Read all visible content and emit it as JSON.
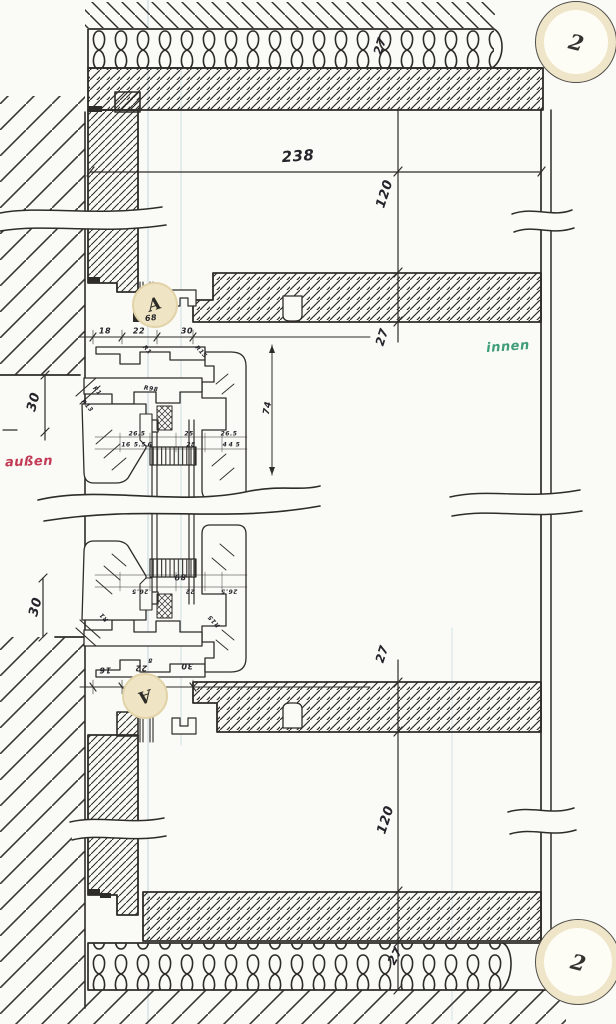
{
  "drawing": {
    "kind": "scanned hand-drawn window section detail",
    "outside_label": "außen",
    "inside_label": "innen"
  },
  "colors": {
    "paper": "#fafaf7",
    "ink": "#2e2c28",
    "red_label": "#c23a56",
    "green_label": "#3f9e78",
    "marker_beige": "#efe5c5",
    "scan_line": "#bcd3d8"
  },
  "markers": [
    {
      "letter": "A",
      "x": 155,
      "y": 305,
      "r": 21,
      "rot": -18,
      "style": "detail",
      "name": "detail-marker-a-top"
    },
    {
      "letter": "A",
      "x": 145,
      "y": 696,
      "r": 21,
      "rot": 162,
      "style": "detail",
      "name": "detail-marker-a-bottom"
    },
    {
      "letter": "2",
      "x": 576,
      "y": 42,
      "r": 40,
      "rot": 14,
      "style": "sheet",
      "name": "sheet-marker-2-top"
    },
    {
      "letter": "2",
      "x": 578,
      "y": 962,
      "r": 42,
      "rot": 14,
      "style": "sheet",
      "name": "sheet-marker-2-bottom"
    }
  ],
  "annotations": [
    {
      "text": "27",
      "x": 380,
      "y": 46,
      "rot": -72,
      "size": 12,
      "name": "dim-insulation-top"
    },
    {
      "text": "238",
      "x": 298,
      "y": 156,
      "rot": -4,
      "size": 15,
      "name": "dim-opening-width"
    },
    {
      "text": "120",
      "x": 385,
      "y": 194,
      "rot": -72,
      "size": 13,
      "name": "dim-reveal-top"
    },
    {
      "text": "27",
      "x": 382,
      "y": 337,
      "rot": -72,
      "size": 12,
      "name": "dim-lintel-top"
    },
    {
      "text": "30",
      "x": 34,
      "y": 402,
      "rot": -75,
      "size": 13,
      "name": "dim-left-top"
    },
    {
      "text": "30",
      "x": 36,
      "y": 607,
      "rot": -75,
      "size": 13,
      "name": "dim-left-bottom"
    },
    {
      "text": "27",
      "x": 382,
      "y": 654,
      "rot": -72,
      "size": 12,
      "name": "dim-lintel-bottom"
    },
    {
      "text": "120",
      "x": 386,
      "y": 820,
      "rot": -72,
      "size": 13,
      "name": "dim-reveal-bottom"
    },
    {
      "text": "27",
      "x": 395,
      "y": 956,
      "rot": -62,
      "size": 12,
      "name": "dim-insulation-bottom"
    },
    {
      "text": "außen",
      "x": 29,
      "y": 462,
      "rot": -2,
      "size": 13,
      "color": "red",
      "name": "region-label-aussen"
    },
    {
      "text": "innen",
      "x": 508,
      "y": 347,
      "rot": -4,
      "size": 13,
      "color": "green",
      "name": "region-label-innen"
    },
    {
      "text": "18",
      "x": 105,
      "y": 331,
      "rot": 0,
      "size": 8,
      "name": "dim-frame-top-1"
    },
    {
      "text": "22",
      "x": 139,
      "y": 331,
      "rot": 0,
      "size": 8,
      "name": "dim-frame-top-2"
    },
    {
      "text": "30",
      "x": 187,
      "y": 331,
      "rot": 0,
      "size": 8,
      "name": "dim-frame-top-3"
    },
    {
      "text": "68",
      "x": 151,
      "y": 318,
      "rot": -6,
      "size": 8,
      "name": "dim-frame-top-sum"
    },
    {
      "text": "16",
      "x": 105,
      "y": 670,
      "rot": 180,
      "size": 8,
      "name": "dim-frame-bot-1"
    },
    {
      "text": "22",
      "x": 141,
      "y": 668,
      "rot": 180,
      "size": 8,
      "name": "dim-frame-bot-2"
    },
    {
      "text": "30",
      "x": 187,
      "y": 666,
      "rot": 180,
      "size": 8,
      "name": "dim-frame-bot-3"
    },
    {
      "text": "89",
      "x": 180,
      "y": 577,
      "rot": 178,
      "size": 8,
      "name": "dim-frame-bot-sum"
    },
    {
      "text": "74",
      "x": 268,
      "y": 408,
      "rot": -80,
      "size": 9,
      "name": "dim-sash-height"
    },
    {
      "text": "26.5",
      "x": 137,
      "y": 434,
      "rot": 0,
      "size": 6,
      "name": "dim-profile-1"
    },
    {
      "text": "25",
      "x": 189,
      "y": 434,
      "rot": 0,
      "size": 6,
      "name": "dim-profile-2"
    },
    {
      "text": "26.5",
      "x": 229,
      "y": 434,
      "rot": 0,
      "size": 6,
      "name": "dim-profile-3"
    },
    {
      "text": "16",
      "x": 126,
      "y": 445,
      "rot": 0,
      "size": 6,
      "name": "dim-profile-4"
    },
    {
      "text": "5.5",
      "x": 140,
      "y": 445,
      "rot": 0,
      "size": 6,
      "name": "dim-profile-5"
    },
    {
      "text": "6",
      "x": 150,
      "y": 445,
      "rot": 0,
      "size": 6,
      "name": "dim-profile-6"
    },
    {
      "text": "28",
      "x": 191,
      "y": 445,
      "rot": 0,
      "size": 6,
      "name": "dim-profile-7"
    },
    {
      "text": "4",
      "x": 225,
      "y": 445,
      "rot": 0,
      "size": 6,
      "name": "dim-profile-8"
    },
    {
      "text": "4",
      "x": 231,
      "y": 445,
      "rot": 0,
      "size": 6,
      "name": "dim-profile-9"
    },
    {
      "text": "5",
      "x": 238,
      "y": 445,
      "rot": 0,
      "size": 6,
      "name": "dim-profile-10"
    },
    {
      "text": "R15",
      "x": 201,
      "y": 352,
      "rot": 48,
      "size": 6,
      "name": "radius-label-1"
    },
    {
      "text": "R1",
      "x": 147,
      "y": 350,
      "rot": 48,
      "size": 6,
      "name": "radius-label-2"
    },
    {
      "text": "R98",
      "x": 151,
      "y": 389,
      "rot": 8,
      "size": 6,
      "name": "radius-label-3"
    },
    {
      "text": "R1",
      "x": 97,
      "y": 391,
      "rot": 48,
      "size": 6,
      "name": "radius-label-4"
    },
    {
      "text": "R13",
      "x": 87,
      "y": 406,
      "rot": 48,
      "size": 6,
      "name": "radius-label-5"
    },
    {
      "text": "26.5",
      "x": 140,
      "y": 591,
      "rot": 180,
      "size": 6,
      "name": "dim-profile-11"
    },
    {
      "text": "22",
      "x": 190,
      "y": 591,
      "rot": 180,
      "size": 6,
      "name": "dim-profile-12"
    },
    {
      "text": "26.5",
      "x": 229,
      "y": 591,
      "rot": 180,
      "size": 6,
      "name": "dim-profile-13"
    },
    {
      "text": "R1",
      "x": 104,
      "y": 617,
      "rot": 228,
      "size": 6,
      "name": "radius-label-6"
    },
    {
      "text": "R15",
      "x": 214,
      "y": 621,
      "rot": 228,
      "size": 6,
      "name": "radius-label-7"
    },
    {
      "text": "8",
      "x": 150,
      "y": 660,
      "rot": 180,
      "size": 6,
      "name": "dim-profile-14"
    }
  ]
}
